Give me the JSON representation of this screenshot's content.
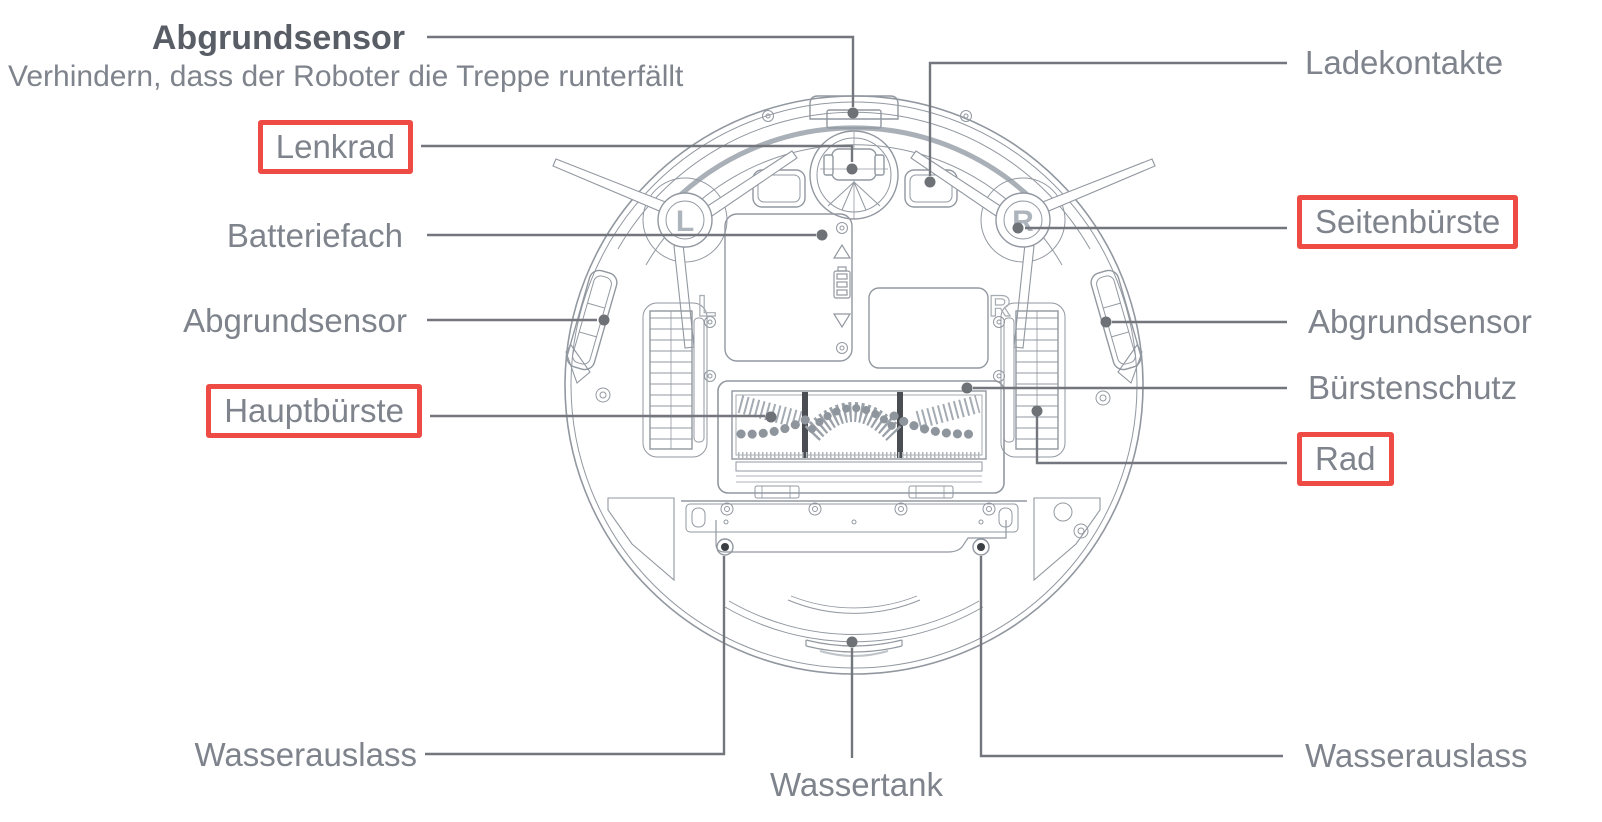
{
  "doc": {
    "type": "robot-vacuum-underside-diagram",
    "language": "de"
  },
  "colors": {
    "highlight_red": "#ef4b45",
    "label_gray": "#7e838c",
    "title_gray": "#595e66",
    "leader_line_gray": "#73777d",
    "drawing_gray": "#9298a0"
  },
  "header": {
    "title": "Abgrundsensor",
    "subtitle": "Verhindern, dass der Roboter die Treppe runterfällt"
  },
  "labels": {
    "lenkrad": {
      "text": "Lenkrad",
      "highlighted": true
    },
    "batteriefach": {
      "text": "Batteriefach",
      "highlighted": false
    },
    "abgrundsensor_left": {
      "text": "Abgrundsensor",
      "highlighted": false
    },
    "hauptbuerste": {
      "text": "Hauptbürste",
      "highlighted": true
    },
    "wasserauslass_left": {
      "text": "Wasserauslass",
      "highlighted": false
    },
    "wassertank": {
      "text": "Wassertank",
      "highlighted": false
    },
    "ladekontakte": {
      "text": "Ladekontakte",
      "highlighted": false
    },
    "seitenbuerste": {
      "text": "Seitenbürste",
      "highlighted": true
    },
    "abgrundsensor_right": {
      "text": "Abgrundsensor",
      "highlighted": false
    },
    "buerstenschutz": {
      "text": "Bürstenschutz",
      "highlighted": false
    },
    "rad": {
      "text": "Rad",
      "highlighted": true
    },
    "wasserauslass_right": {
      "text": "Wasserauslass",
      "highlighted": false
    }
  },
  "diagram": {
    "hub_left": "L",
    "hub_right": "R",
    "floor_left": "L",
    "floor_right": "R"
  }
}
